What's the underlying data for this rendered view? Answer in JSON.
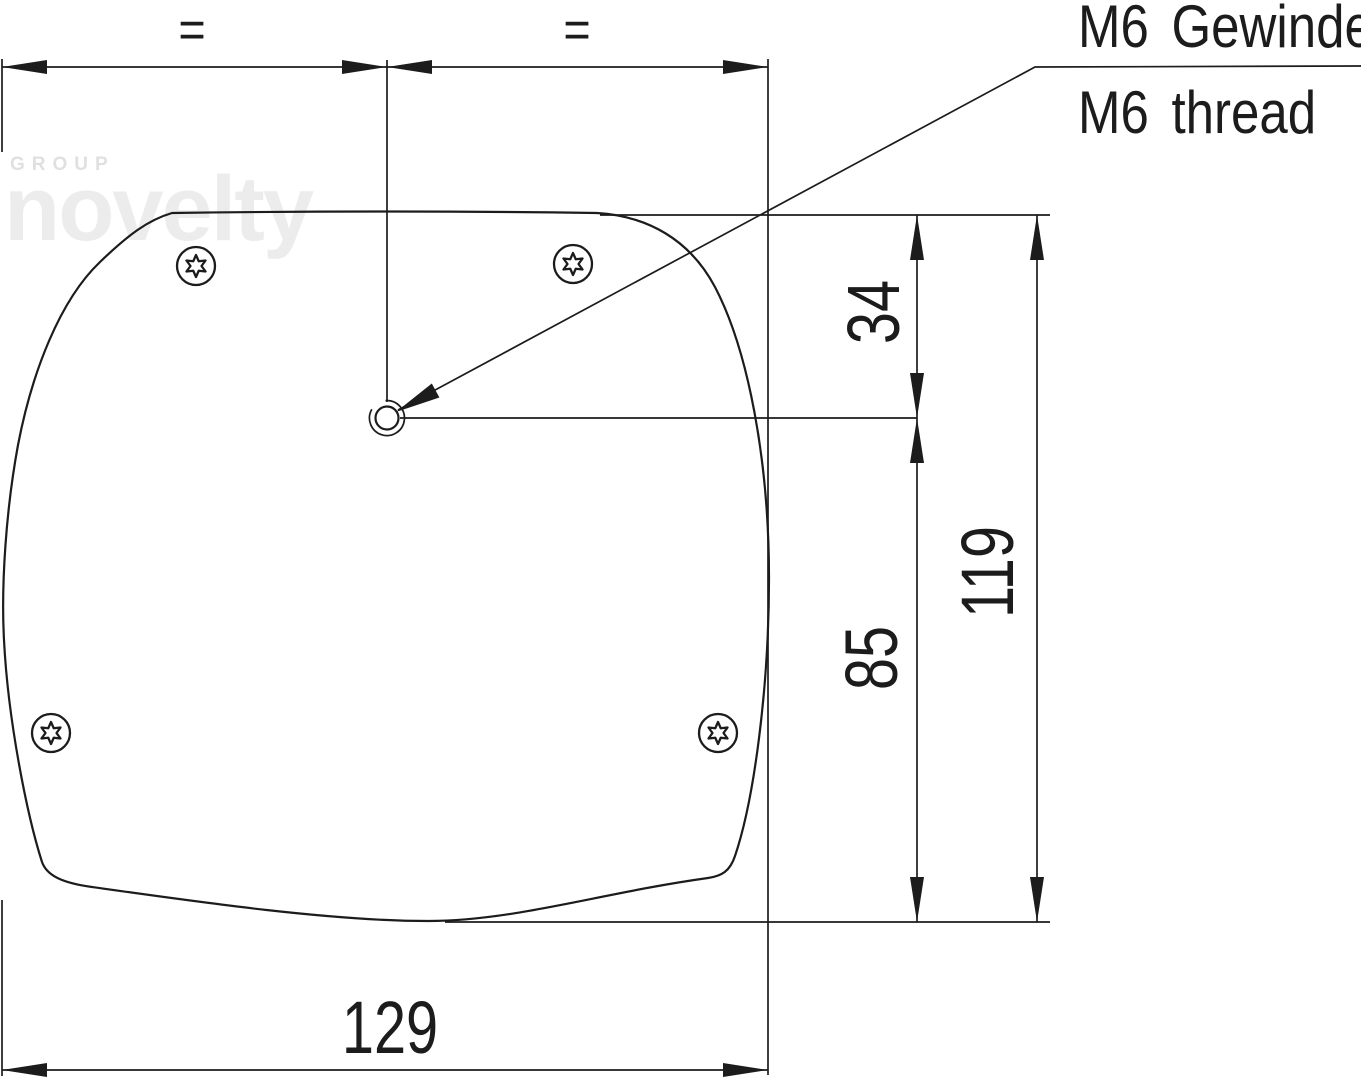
{
  "drawing_type": "technical-dimension-drawing",
  "callout": {
    "german": "M6 Gewinde",
    "english": "M6 thread"
  },
  "dimensions": {
    "equal_left": "=",
    "equal_right": "=",
    "offset_top": "34",
    "height_total": "119",
    "offset_bottom": "85",
    "width": "129"
  },
  "watermark": {
    "group": "GROUP",
    "brand": "novelty"
  },
  "features": {
    "screw_icon": "torx-screw",
    "screw_count": 4,
    "center_hole": "threaded-hole"
  },
  "colors": {
    "line": "#1c1c1c",
    "watermark_light": "#ececec",
    "watermark_dark": "#e0e0e0",
    "background": "#ffffff"
  }
}
